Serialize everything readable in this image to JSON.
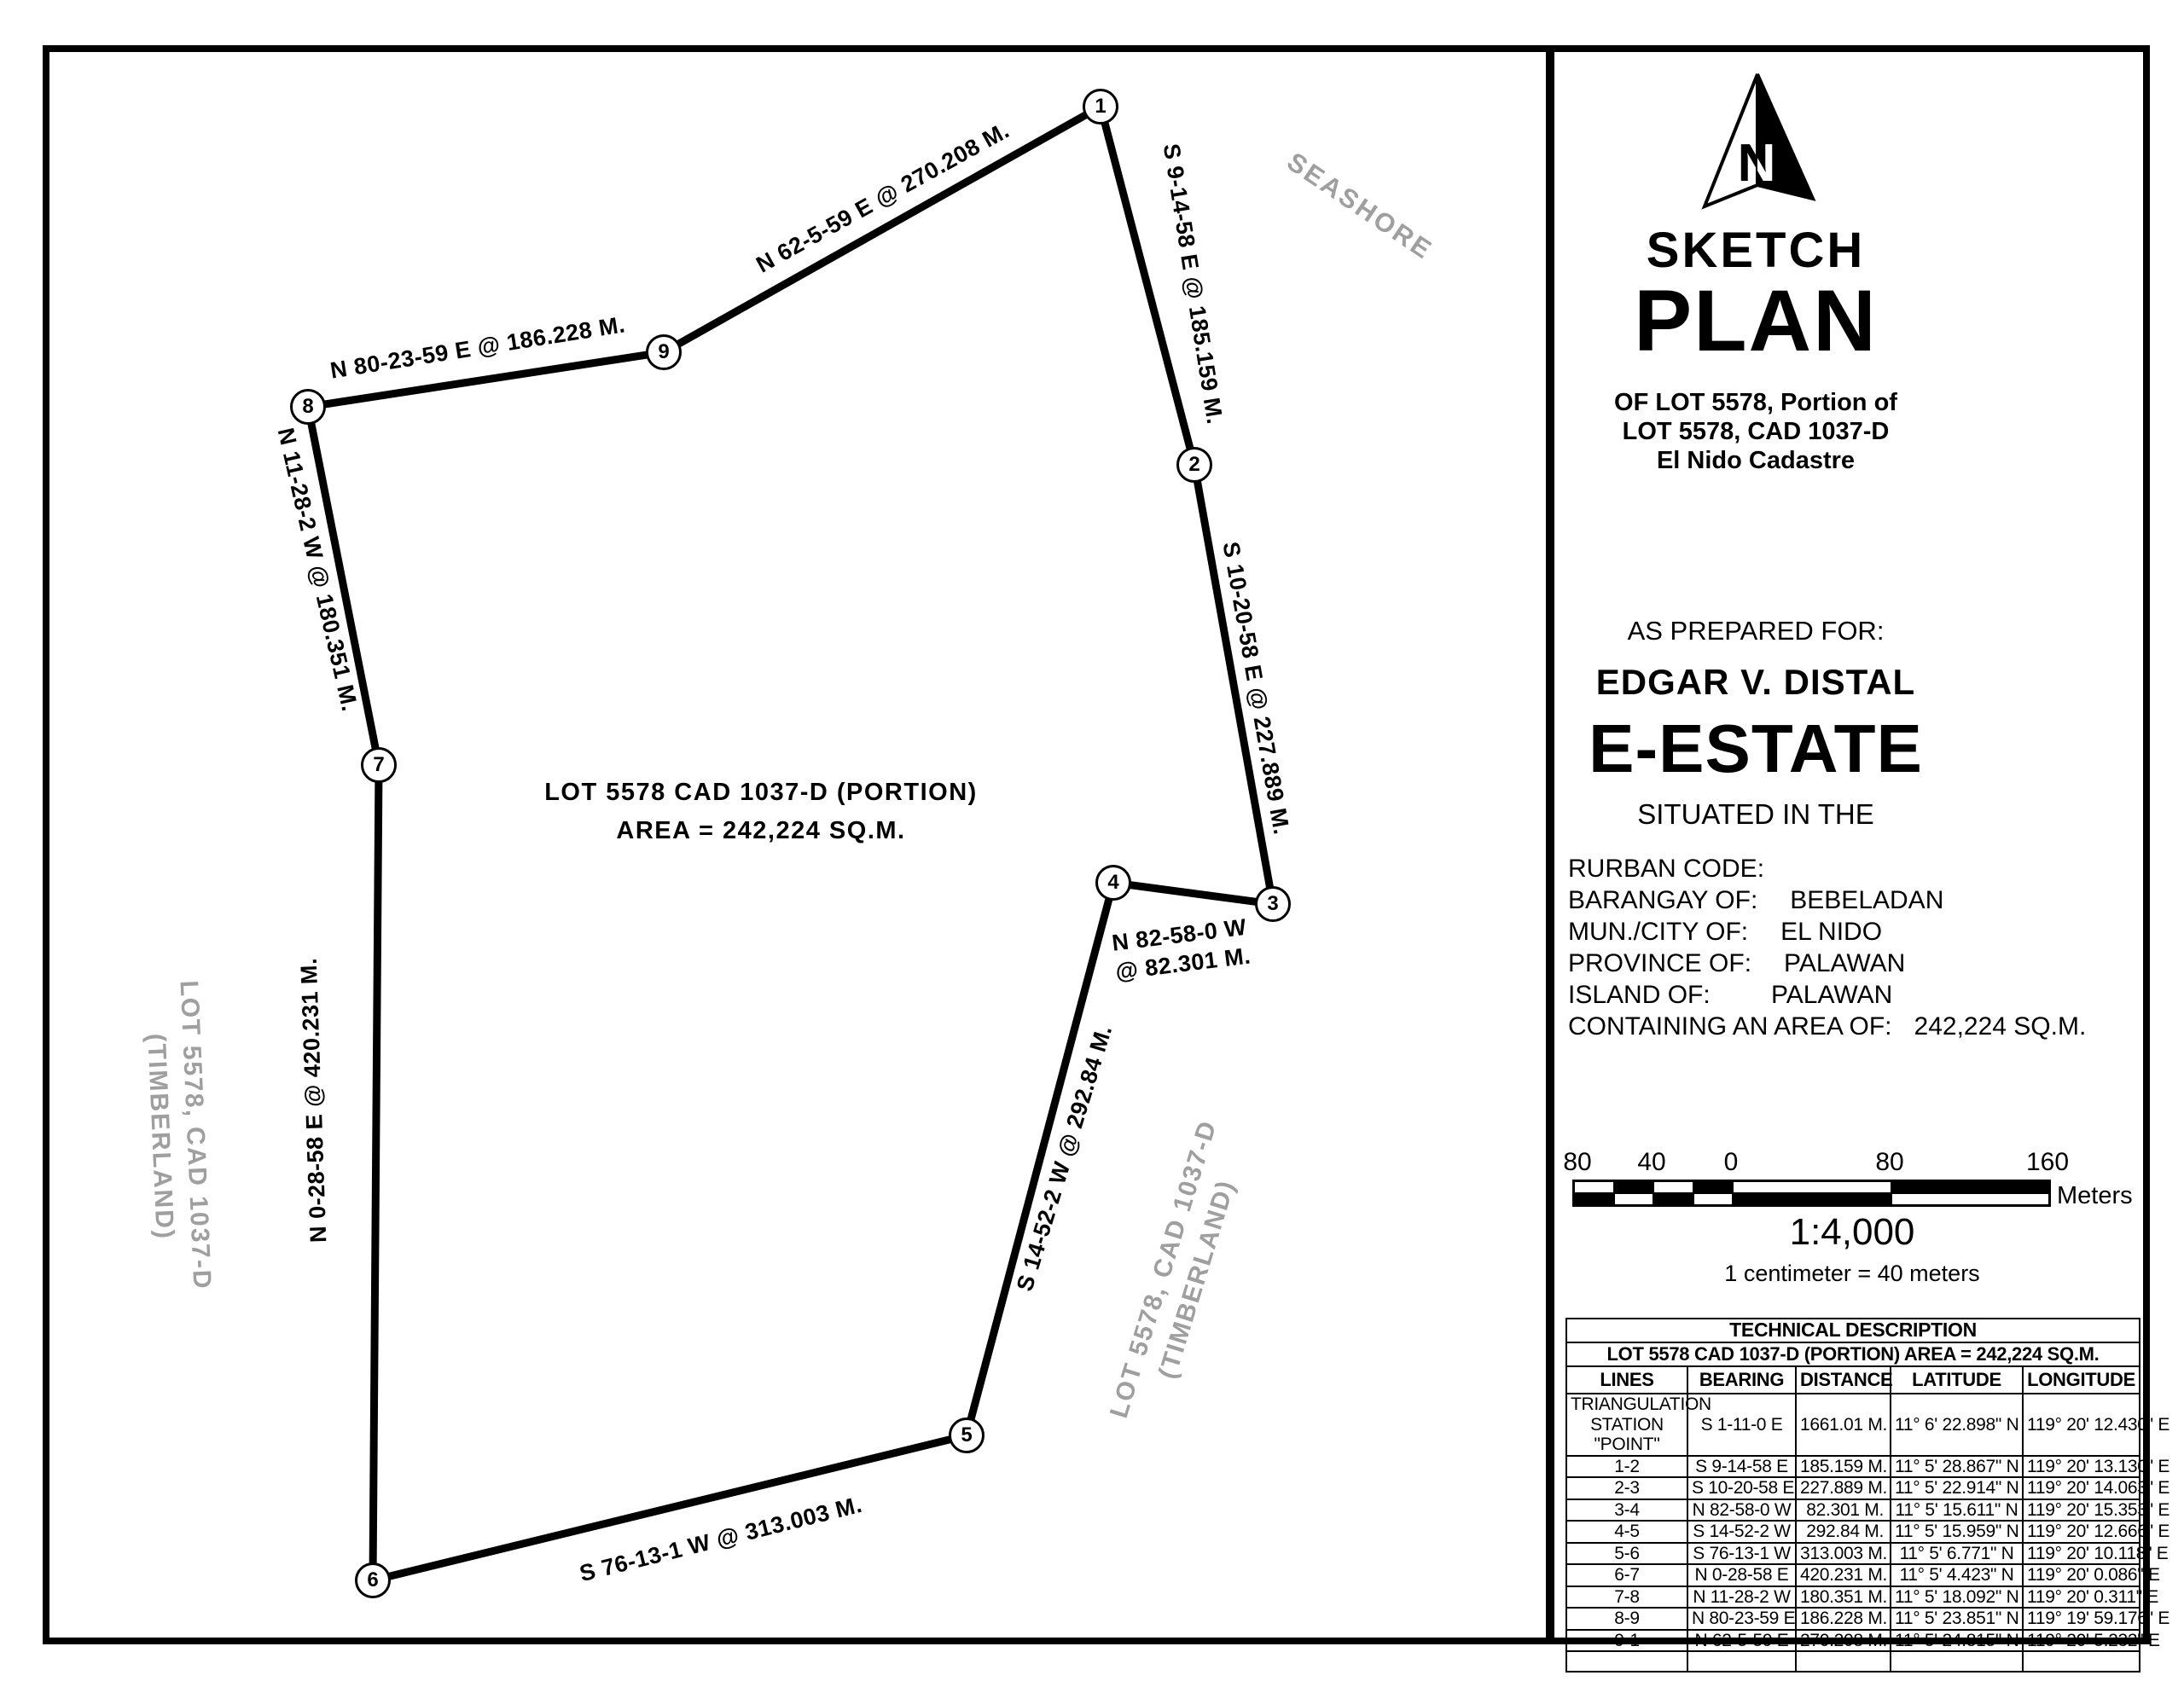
{
  "map": {
    "area_label": {
      "line1": "LOT 5578 CAD 1037-D (PORTION)",
      "line2": "AREA = 242,224 SQ.M."
    },
    "seashore": "SEASHORE",
    "timberland_left": {
      "line1": "LOT 5578, CAD 1037-D",
      "line2": "(TIMBERLAND)"
    },
    "timberland_right": {
      "line1": "LOT 5578, CAD 1037-D",
      "line2": "(TIMBERLAND)"
    },
    "vertices": [
      "1",
      "2",
      "3",
      "4",
      "5",
      "6",
      "7",
      "8",
      "9"
    ],
    "edge_labels": [
      {
        "edge": "9-1",
        "text": "N 62-5-59 E @ 270.208 M."
      },
      {
        "edge": "1-2",
        "text": "S 9-14-58 E @ 185.159 M."
      },
      {
        "edge": "2-3",
        "text": "S 10-20-58 E @ 227.889 M."
      },
      {
        "edge": "3-4",
        "text": "N 82-58-0 W @ 82.301 M."
      },
      {
        "edge": "4-5",
        "text": "S 14-52-2 W @ 292.84 M."
      },
      {
        "edge": "5-6",
        "text": "S 76-13-1 W @ 313.003 M."
      },
      {
        "edge": "6-7",
        "text": "N 0-28-58 E @ 420.231 M."
      },
      {
        "edge": "7-8",
        "text": "N 11-28-2 W @ 180.351 M."
      },
      {
        "edge": "8-9",
        "text": "N 80-23-59 E @ 186.228 M."
      }
    ]
  },
  "title_block": {
    "north_label": "N",
    "title1": "SKETCH",
    "title2": "PLAN",
    "subtitle": {
      "line1": "OF LOT 5578, Portion of",
      "line2": "LOT 5578, CAD 1037-D",
      "line3": "El Nido Cadastre"
    },
    "prepared_for_label": "AS PREPARED FOR:",
    "prepared_for_name": "EDGAR V. DISTAL",
    "estate_name": "E-ESTATE",
    "situated": "SITUATED IN THE",
    "location": [
      {
        "label": "RURBAN CODE:",
        "value": ""
      },
      {
        "label": "BARANGAY OF:",
        "value": "BEBELADAN"
      },
      {
        "label": "MUN./CITY OF:",
        "value": "EL NIDO"
      },
      {
        "label": "PROVINCE OF:",
        "value": "PALAWAN"
      },
      {
        "label": "ISLAND OF:",
        "value": "PALAWAN"
      },
      {
        "label": "CONTAINING AN AREA OF:",
        "value": "242,224 SQ.M."
      }
    ],
    "scale": {
      "ticks": [
        "80",
        "40",
        "0",
        "80",
        "160"
      ],
      "unit": "Meters",
      "ratio": "1:4,000",
      "note": "1 centimeter = 40 meters"
    }
  },
  "tech_table": {
    "title": "TECHNICAL DESCRIPTION",
    "subtitle": "LOT 5578 CAD 1037-D (PORTION) AREA = 242,224 SQ.M.",
    "headers": [
      "LINES",
      "BEARING",
      "DISTANCE",
      "LATITUDE",
      "LONGITUDE"
    ],
    "rows": [
      {
        "lines": "TRIANGULATION STATION \"POINT\"",
        "bearing": "S 1-11-0 E",
        "distance": "1661.01 M.",
        "latitude": "11° 6' 22.898\" N",
        "longitude": "119° 20' 12.430\" E"
      },
      {
        "lines": "1-2",
        "bearing": "S 9-14-58 E",
        "distance": "185.159 M.",
        "latitude": "11° 5' 28.867\" N",
        "longitude": "119° 20' 13.130\" E"
      },
      {
        "lines": "2-3",
        "bearing": "S 10-20-58 E",
        "distance": "227.889 M.",
        "latitude": "11° 5' 22.914\" N",
        "longitude": "119° 20' 14.063\" E"
      },
      {
        "lines": "3-4",
        "bearing": "N 82-58-0 W",
        "distance": "82.301 M.",
        "latitude": "11° 5' 15.611\" N",
        "longitude": "119° 20' 15.353\" E"
      },
      {
        "lines": "4-5",
        "bearing": "S 14-52-2 W",
        "distance": "292.84 M.",
        "latitude": "11° 5' 15.959\" N",
        "longitude": "119° 20' 12.666\" E"
      },
      {
        "lines": "5-6",
        "bearing": "S 76-13-1 W",
        "distance": "313.003 M.",
        "latitude": "11° 5' 6.771\" N",
        "longitude": "119° 20' 10.118\" E"
      },
      {
        "lines": "6-7",
        "bearing": "N 0-28-58 E",
        "distance": "420.231 M.",
        "latitude": "11° 5' 4.423\" N",
        "longitude": "119° 20' 0.086\" E"
      },
      {
        "lines": "7-8",
        "bearing": "N 11-28-2 W",
        "distance": "180.351 M.",
        "latitude": "11° 5' 18.092\" N",
        "longitude": "119° 20' 0.311\" E"
      },
      {
        "lines": "8-9",
        "bearing": "N 80-23-59 E",
        "distance": "186.228 M.",
        "latitude": "11° 5' 23.851\" N",
        "longitude": "119° 19' 59.176\" E"
      },
      {
        "lines": "9-1",
        "bearing": "N 62-5-59 E",
        "distance": "270.208 M.",
        "latitude": "11° 5' 24.815\" N",
        "longitude": "119° 20' 5.232\" E"
      }
    ]
  }
}
